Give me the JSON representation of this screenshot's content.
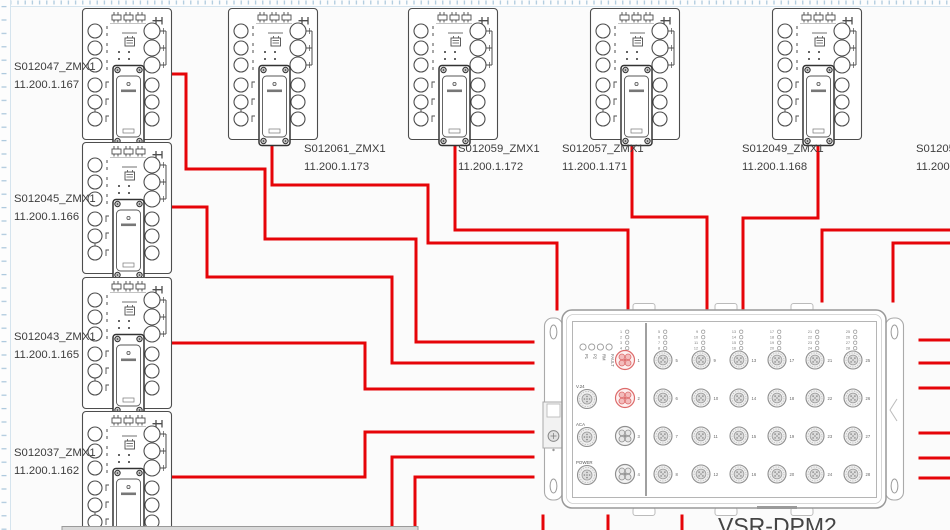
{
  "app": {
    "title": "network wiring diagram canvas"
  },
  "devices": [
    {
      "name": "S012047_ZMX1",
      "ip": "11.200.1.167",
      "x": 82,
      "y": 8,
      "label_x": 14,
      "label_y": 70
    },
    {
      "name": "S012045_ZMX1",
      "ip": "11.200.1.166",
      "x": 82,
      "y": 142,
      "label_x": 14,
      "label_y": 202
    },
    {
      "name": "S012043_ZMX1",
      "ip": "11.200.1.165",
      "x": 82,
      "y": 277,
      "label_x": 14,
      "label_y": 340
    },
    {
      "name": "S012037_ZMX1",
      "ip": "11.200.1.162",
      "x": 82,
      "y": 411,
      "label_x": 14,
      "label_y": 456
    },
    {
      "name": "S012061_ZMX1",
      "ip": "11.200.1.173",
      "x": 228,
      "y": 8,
      "label_x": 304,
      "label_y": 152
    },
    {
      "name": "S012059_ZMX1",
      "ip": "11.200.1.172",
      "x": 408,
      "y": 8,
      "label_x": 458,
      "label_y": 152
    },
    {
      "name": "S012057_ZMX1",
      "ip": "11.200.1.171",
      "x": 590,
      "y": 8,
      "label_x": 562,
      "label_y": 152
    },
    {
      "name": "S012049_ZMX1",
      "ip": "11.200.1.168",
      "x": 772,
      "y": 8,
      "label_x": 742,
      "label_y": 152
    }
  ],
  "offscreen_device_label": {
    "name": "S012053",
    "ip": "11.200.1",
    "label_x": 916,
    "label_y": 152
  },
  "cables": [
    {
      "from": "s012047",
      "points": [
        [
          172,
          74
        ],
        [
          186,
          74
        ],
        [
          186,
          169
        ],
        [
          265,
          169
        ],
        [
          265,
          239
        ],
        [
          416,
          239
        ],
        [
          416,
          342
        ],
        [
          533,
          342
        ]
      ]
    },
    {
      "from": "s012045",
      "points": [
        [
          172,
          207
        ],
        [
          207,
          207
        ],
        [
          207,
          277
        ],
        [
          392,
          277
        ],
        [
          392,
          363
        ],
        [
          533,
          363
        ]
      ]
    },
    {
      "from": "s012043",
      "points": [
        [
          172,
          343
        ],
        [
          365,
          343
        ],
        [
          365,
          389
        ],
        [
          533,
          389
        ]
      ]
    },
    {
      "from": "s012037",
      "points": [
        [
          172,
          477
        ],
        [
          365,
          477
        ],
        [
          365,
          432
        ],
        [
          533,
          432
        ]
      ]
    },
    {
      "from": "s012061",
      "points": [
        [
          272,
          139
        ],
        [
          272,
          185
        ],
        [
          428,
          185
        ],
        [
          428,
          243
        ],
        [
          557,
          243
        ],
        [
          557,
          309
        ]
      ]
    },
    {
      "from": "s012059",
      "points": [
        [
          455,
          140
        ],
        [
          455,
          230
        ],
        [
          628,
          230
        ],
        [
          628,
          309
        ]
      ]
    },
    {
      "from": "s012057",
      "points": [
        [
          632,
          140
        ],
        [
          632,
          217
        ],
        [
          707,
          217
        ],
        [
          707,
          309
        ]
      ]
    },
    {
      "from": "s012049",
      "points": [
        [
          818,
          141
        ],
        [
          818,
          218
        ],
        [
          743,
          218
        ],
        [
          743,
          309
        ]
      ]
    },
    {
      "from": "offscreen-right-1",
      "points": [
        [
          950,
          230
        ],
        [
          822,
          230
        ],
        [
          822,
          301
        ]
      ]
    },
    {
      "from": "offscreen-right-2",
      "points": [
        [
          950,
          243
        ],
        [
          893,
          243
        ],
        [
          893,
          301
        ]
      ]
    },
    {
      "from": "offscreen-bottom-1",
      "points": [
        [
          392,
          530
        ],
        [
          392,
          457
        ],
        [
          533,
          457
        ]
      ]
    },
    {
      "from": "offscreen-bottom-2",
      "points": [
        [
          415,
          530
        ],
        [
          415,
          477
        ],
        [
          533,
          477
        ]
      ]
    },
    {
      "from": "dpm-right-1",
      "points": [
        [
          920,
          340
        ],
        [
          950,
          340
        ]
      ]
    },
    {
      "from": "dpm-right-2",
      "points": [
        [
          920,
          363
        ],
        [
          950,
          363
        ]
      ]
    },
    {
      "from": "dpm-right-3",
      "points": [
        [
          920,
          388
        ],
        [
          950,
          388
        ]
      ]
    },
    {
      "from": "dpm-right-4",
      "points": [
        [
          920,
          433
        ],
        [
          950,
          433
        ]
      ]
    },
    {
      "from": "dpm-right-5",
      "points": [
        [
          920,
          458
        ],
        [
          950,
          458
        ]
      ]
    },
    {
      "from": "dpm-right-6",
      "points": [
        [
          920,
          478
        ],
        [
          950,
          478
        ]
      ]
    },
    {
      "from": "dpm-bottom-1",
      "points": [
        [
          543,
          516
        ],
        [
          543,
          530
        ]
      ]
    },
    {
      "from": "dpm-bottom-2",
      "points": [
        [
          608,
          516
        ],
        [
          608,
          530
        ]
      ]
    },
    {
      "from": "dpm-bottom-3",
      "points": [
        [
          682,
          516
        ],
        [
          682,
          530
        ]
      ]
    }
  ],
  "dpm": {
    "label": "VSR-DPM2",
    "status_leds": [
      "P1",
      "P2",
      "RM",
      "FAULT"
    ],
    "aux_connectors": [
      {
        "label": "V.24",
        "cy": 399
      },
      {
        "label": "ACA",
        "cy": 437
      },
      {
        "label": "POWER",
        "cy": 475
      }
    ],
    "port_columns": [
      [
        1,
        2,
        3,
        4
      ],
      [
        5,
        6,
        7,
        8
      ],
      [
        9,
        10,
        11,
        12
      ],
      [
        13,
        14,
        15,
        16
      ],
      [
        17,
        18,
        19,
        20
      ],
      [
        21,
        22,
        23,
        24
      ],
      [
        25,
        26,
        27,
        28
      ]
    ],
    "highlighted_ports": [
      1,
      2
    ]
  },
  "colors": {
    "cable": "#e60408",
    "device_stroke": "#4d4d4d",
    "dpm_stroke": "#999999",
    "highlight_stroke": "#dd6b6b",
    "highlight_fill": "#f3bcbc",
    "label_text": "#3d3d3d",
    "ruler_tick": "#a9c7dc"
  }
}
